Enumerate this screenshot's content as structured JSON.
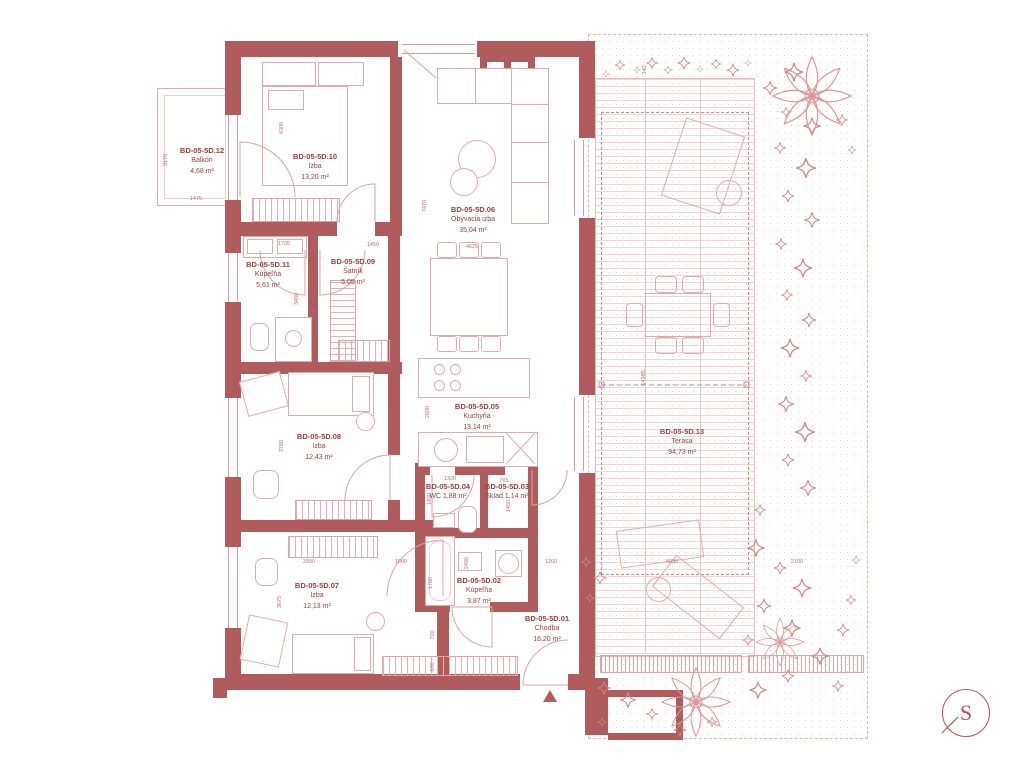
{
  "rooms": [
    {
      "code": "BD-05-5D.12",
      "name": "Balkón",
      "area": "4,68 m²"
    },
    {
      "code": "BD-05-5D.10",
      "name": "Izba",
      "area": "13,20 m²"
    },
    {
      "code": "BD-05-5D.06",
      "name": "Obývacia izba",
      "area": "35,04 m²"
    },
    {
      "code": "BD-05-5D.11",
      "name": "Kúpeľňa",
      "area": "5,61 m²"
    },
    {
      "code": "BD-05-5D.09",
      "name": "Šatník",
      "area": "5,05 m²"
    },
    {
      "code": "BD-05-5D.05",
      "name": "Kuchyňa",
      "area": "13,14 m²"
    },
    {
      "code": "BD-05-5D.08",
      "name": "Izba",
      "area": "12,43 m²"
    },
    {
      "code": "BD-05-5D.04",
      "name": "WC",
      "area": "1,88 m²"
    },
    {
      "code": "BD-05-5D.03",
      "name": "Sklad",
      "area": "1,14 m²"
    },
    {
      "code": "BD-05-5D.02",
      "name": "Kúpeľňa",
      "area": "3,87 m²"
    },
    {
      "code": "BD-05-5D.07",
      "name": "Izba",
      "area": "12,13 m²"
    },
    {
      "code": "BD-05-5D.01",
      "name": "Chodba",
      "area": "16,20 m²"
    },
    {
      "code": "BD-05-5D.13",
      "name": "Terasa",
      "area": "94,73 m²"
    }
  ],
  "dimensions": [
    "3170",
    "1475",
    "4300",
    "7470",
    "1735",
    "1450",
    "3480",
    "4625",
    "2600",
    "3765",
    "1320",
    "765",
    "1450",
    "1450",
    "2400",
    "1200",
    "3300",
    "1000",
    "3675",
    "1700",
    "700",
    "600",
    "14385",
    "4090",
    "2100",
    "340"
  ],
  "compass": {
    "letter": "S"
  },
  "colors": {
    "wall": "#b05c5c",
    "line": "#e2abab",
    "text": "#9a4040",
    "dim": "#c4716f"
  }
}
